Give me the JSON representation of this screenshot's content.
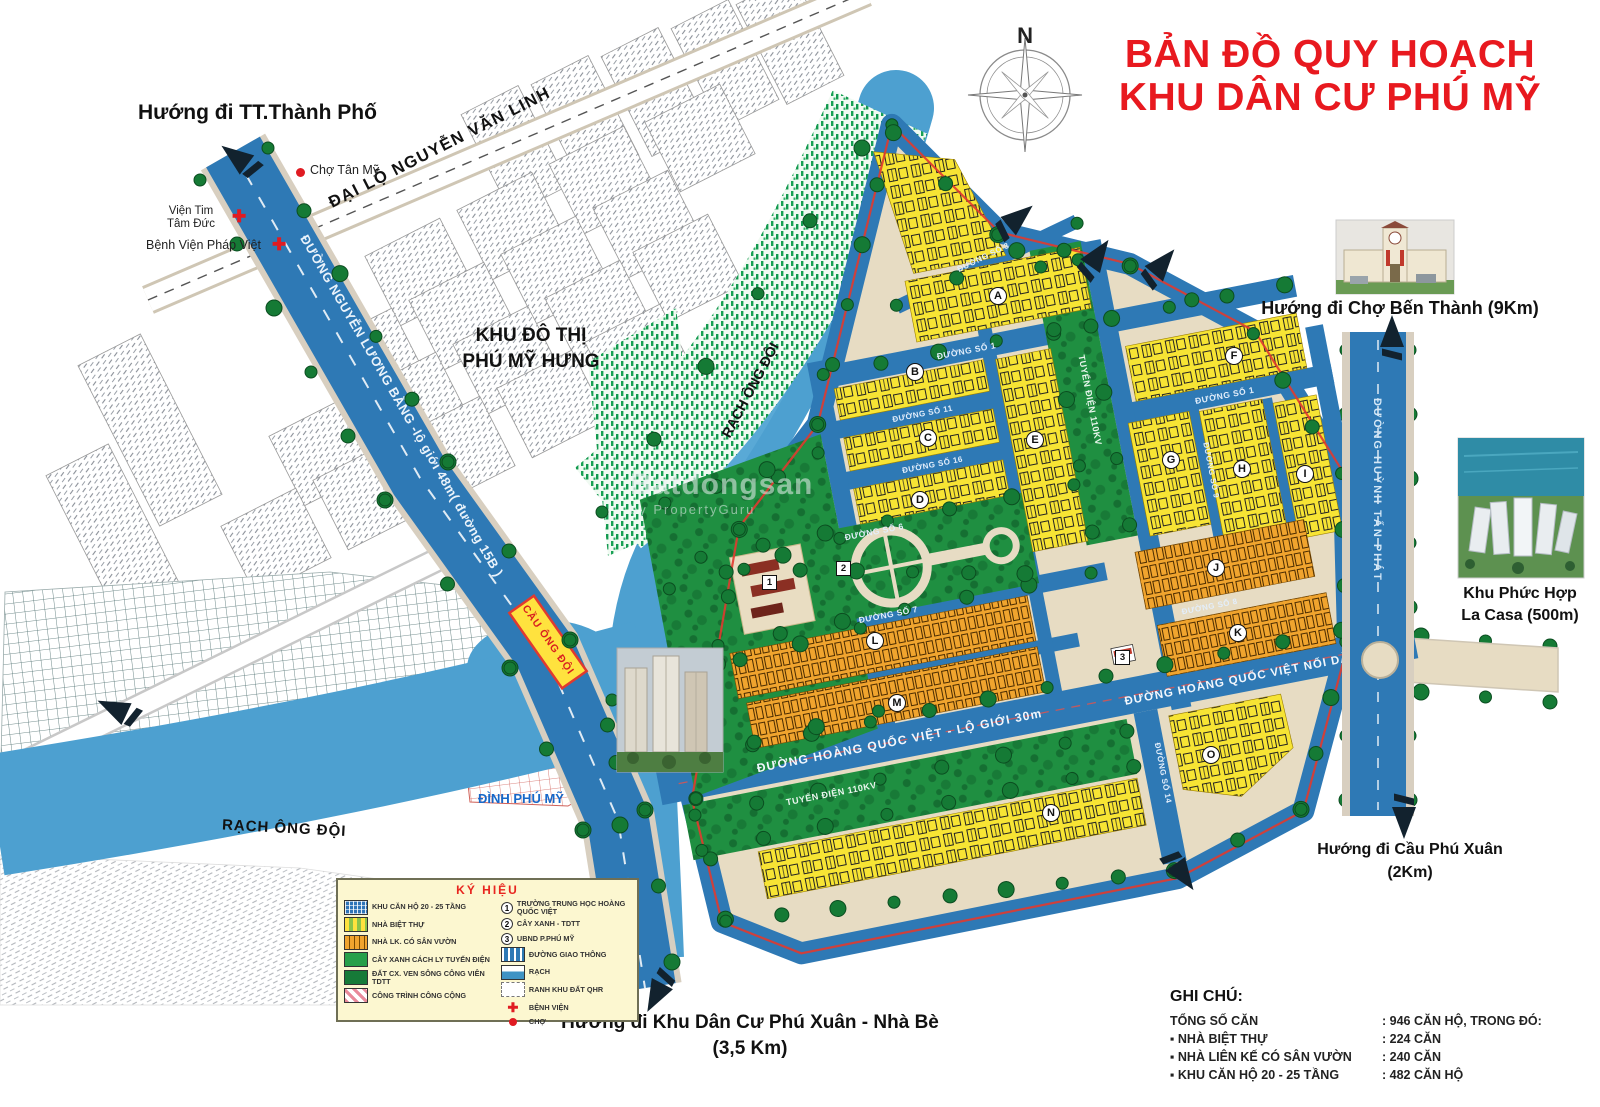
{
  "title": {
    "line1": "BẢN ĐỒ QUY HOẠCH",
    "line2": "KHU DÂN CƯ PHÚ MỸ"
  },
  "compass": {
    "north": "N"
  },
  "directions": {
    "tt_thanh_pho": "Hướng đi TT.Thành Phố",
    "ben_thanh": "Hướng đi Chợ Bến Thành (9Km)",
    "la_casa_line1": "Khu Phức Hợp",
    "la_casa_line2": "La Casa (500m)",
    "cau_phu_xuan_line1": "Hướng đi Cầu Phú Xuân",
    "cau_phu_xuan_line2": "(2Km)",
    "kdc_phu_xuan_line1": "Hướng đi Khu Dân Cư Phú Xuân - Nhà Bè",
    "kdc_phu_xuan_line2": "(3,5 Km)"
  },
  "places": {
    "cho_tan_my": "Chợ Tân Mỹ",
    "vien_tim_line1": "Viện Tim",
    "vien_tim_line2": "Tâm Đức",
    "benh_vien_phap_viet": "Bệnh Viện Pháp Việt",
    "khu_do_thi_line1": "KHU ĐÔ THỊ",
    "khu_do_thi_line2": "PHÚ MỸ HƯNG",
    "dinh_phu_my": "ĐÌNH PHÚ MỸ",
    "rach_ong_doi_upper": "RẠCH ÔNG ĐỘI",
    "rach_ong_doi_lower": "RẠCH ÔNG ĐỘI",
    "cau_ong_doi": "CẦU ÔNG ĐỘI"
  },
  "roads": {
    "nguyen_van_linh": "ĐẠI LỘ NGUYỄN VĂN LINH",
    "nguyen_luong_bang": "ĐƯỜNG NGUYỄN LƯƠNG BẰNG -lộ giới 48m( đường 15B )",
    "hoang_quoc_viet": "ĐƯỜNG HOÀNG QUỐC VIỆT - LỘ GIỚI 30m",
    "hqv_noi_dai": "ĐƯỜNG HOÀNG QUỐC VIỆT NỐI DÀI",
    "huynh_tan_phat": "ĐƯỜNG HUỲNH TẤN PHÁT",
    "tuyen_dien_v": "TUYẾN ĐIỆN 110KV",
    "tuyen_dien_h": "TUYẾN ĐIỆN 110KV",
    "so1": "ĐƯỜNG SỐ 1",
    "so1b": "ĐƯỜNG SỐ 1",
    "so3": "ĐƯỜNG SỐ 3",
    "so6": "ĐƯỜNG SỐ 6",
    "so7": "ĐƯỜNG SỐ 7",
    "so8": "ĐƯỜNG SỐ 8",
    "so9": "ĐƯỜNG SỐ 9",
    "so11": "ĐƯỜNG SỐ 11",
    "so14": "ĐƯỜNG SỐ 14",
    "so16": "ĐƯỜNG SỐ 16"
  },
  "blocks": {
    "letters": [
      "A",
      "B",
      "C",
      "D",
      "E",
      "F",
      "G",
      "H",
      "I",
      "J",
      "K",
      "L",
      "M",
      "N",
      "O"
    ]
  },
  "markers": {
    "m1": "1",
    "m2": "2",
    "m3": "3"
  },
  "legend": {
    "title": "KÝ HIỆU",
    "left": [
      "KHU CĂN HỘ 20 - 25 TẦNG",
      "NHÀ BIỆT THỰ",
      "NHÀ LK. CÓ SÂN VƯỜN",
      "CÂY XANH CÁCH LY TUYẾN ĐIỆN",
      "ĐẤT CX. VEN SÔNG CÔNG VIÊN TDTT",
      "CÔNG TRÌNH CÔNG CỘNG"
    ],
    "numbered": [
      {
        "num": "1",
        "label": "TRƯỜNG TRUNG HỌC HOÀNG QUỐC VIỆT"
      },
      {
        "num": "2",
        "label": "CÂY XANH - TDTT"
      },
      {
        "num": "3",
        "label": "UBND P.PHÚ MỸ"
      }
    ],
    "right": [
      "ĐƯỜNG GIAO THÔNG",
      "RẠCH",
      "RANH KHU ĐẤT QHR",
      "BỆNH VIỆN",
      "CHỢ"
    ]
  },
  "notes": {
    "title": "GHI CHÚ:",
    "rows": [
      {
        "label": "TỔNG SỐ CĂN",
        "value": ": 946 CĂN HỘ, TRONG ĐÓ:"
      },
      {
        "label": "NHÀ BIỆT THỰ",
        "value": ": 224 CĂN"
      },
      {
        "label": "NHÀ LIÊN KẾ CÓ SÂN VƯỜN",
        "value": ": 240 CĂN"
      },
      {
        "label": "KHU CĂN HỘ 20 - 25 TẦNG",
        "value": ": 482 CĂN HỘ"
      }
    ]
  },
  "watermark": {
    "line1": "Batdongsan",
    "line2": "by PropertyGuru"
  },
  "colors": {
    "accent_red": "#e8191f",
    "road_blue": "#2e79b5",
    "water_blue": "#4da0d0",
    "block_yellow": "#f7e434",
    "block_orange": "#f0a42e",
    "green": "#1f8f41"
  }
}
